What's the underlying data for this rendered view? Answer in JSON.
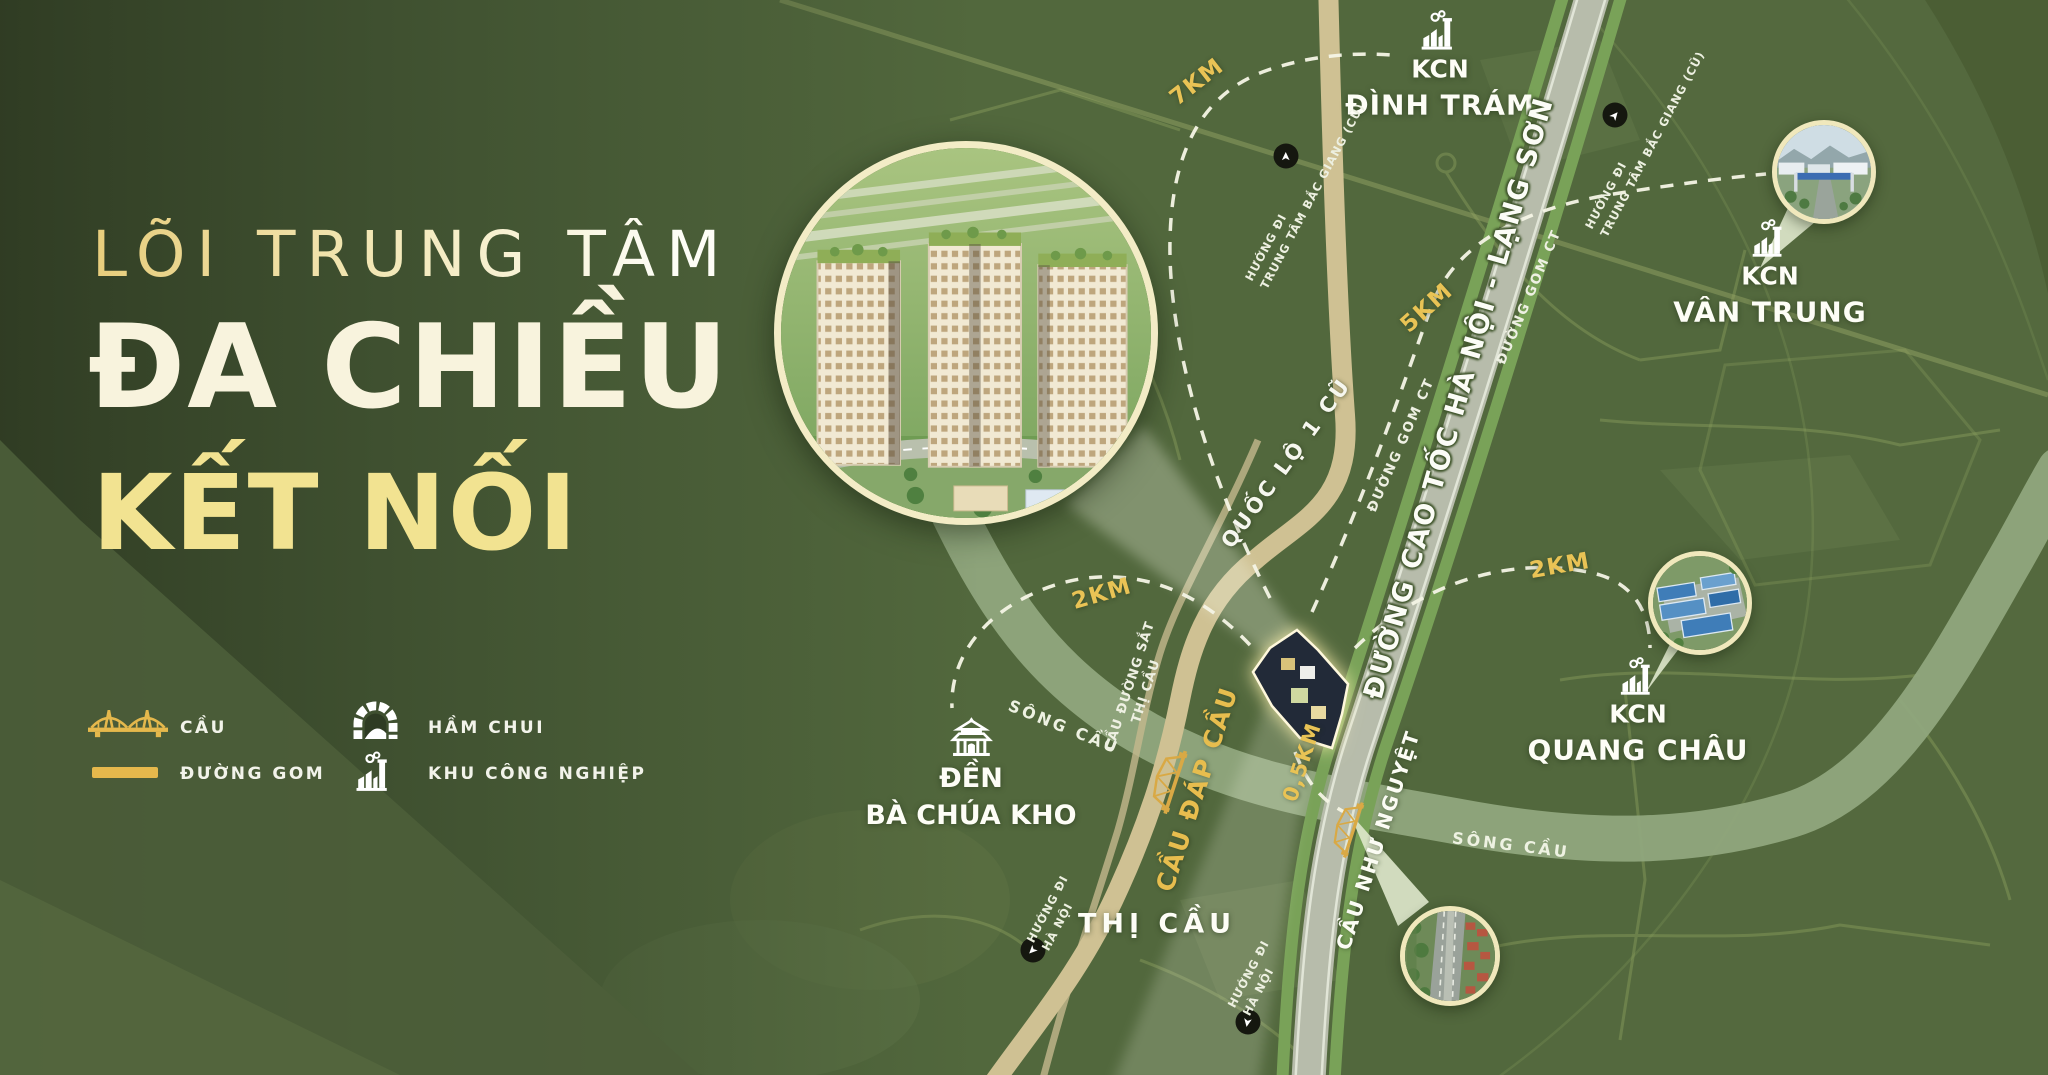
{
  "title": {
    "line1": "LÕI TRUNG TÂM",
    "line2": "ĐA CHIỀU",
    "line3": "KẾT NỐI"
  },
  "legend": {
    "items": [
      {
        "icon": "bridge-icon",
        "label": "CẦU"
      },
      {
        "icon": "underpass-icon",
        "label": "HẦM CHUI"
      },
      {
        "icon": "frontage-road-swatch",
        "label": "ĐƯỜNG GOM"
      },
      {
        "icon": "industrial-zone-icon",
        "label": "KHU CÔNG NGHIỆP"
      }
    ]
  },
  "map": {
    "kcn": [
      {
        "line1": "KCN",
        "line2": "ĐÌNH TRÁM"
      },
      {
        "line1": "KCN",
        "line2": "VÂN TRUNG"
      },
      {
        "line1": "KCN",
        "line2": "QUANG CHÂU"
      }
    ],
    "temple": {
      "line1": "ĐỀN",
      "line2": "BÀ CHÚA KHO"
    },
    "town": "THỊ CẦU",
    "roads": {
      "expressway": "ĐƯỜNG CAO TỐC HÀ NỘI - LẠNG SƠN",
      "national": "QUỐC LỘ 1 CŨ",
      "gom_left": "ĐƯỜNG GOM CT",
      "gom_right": "ĐƯỜNG GOM CT"
    },
    "river": {
      "labels": [
        "SÔNG CẦU",
        "SÔNG CẦU"
      ]
    },
    "bridges": {
      "railway_line1": "CẦU ĐƯỜNG SẮT",
      "railway_line2": "THỊ CẦU",
      "dap_cau": "CẦU ĐÁP CẦU",
      "nhu_nguyet": "CẦU NHƯ NGUYỆT"
    },
    "distances": [
      {
        "value": "7KM"
      },
      {
        "value": "5KM"
      },
      {
        "value": "2KM"
      },
      {
        "value": "2KM"
      },
      {
        "value": "0,5KM"
      }
    ],
    "directions": [
      {
        "line1": "HƯỚNG ĐI",
        "line2": "TRUNG TÂM BẮC GIANG (CŨ)"
      },
      {
        "line1": "HƯỚNG ĐI",
        "line2": "TRUNG TÂM BẮC GIANG (CŨ)"
      },
      {
        "line1": "HƯỚNG ĐI",
        "line2": "HÀ NỘI"
      },
      {
        "line1": "HƯỚNG ĐI",
        "line2": "HÀ NỘI"
      }
    ]
  },
  "colors": {
    "accent_gold": "#e9c355",
    "cream": "#f6f0d8",
    "map_green": "#52683d",
    "dark_green": "#36452a",
    "highway_gray": "#b7bcab",
    "road_tan": "#cfc193",
    "river_green": "#90a67d",
    "bridge_gold": "#d9a945"
  }
}
